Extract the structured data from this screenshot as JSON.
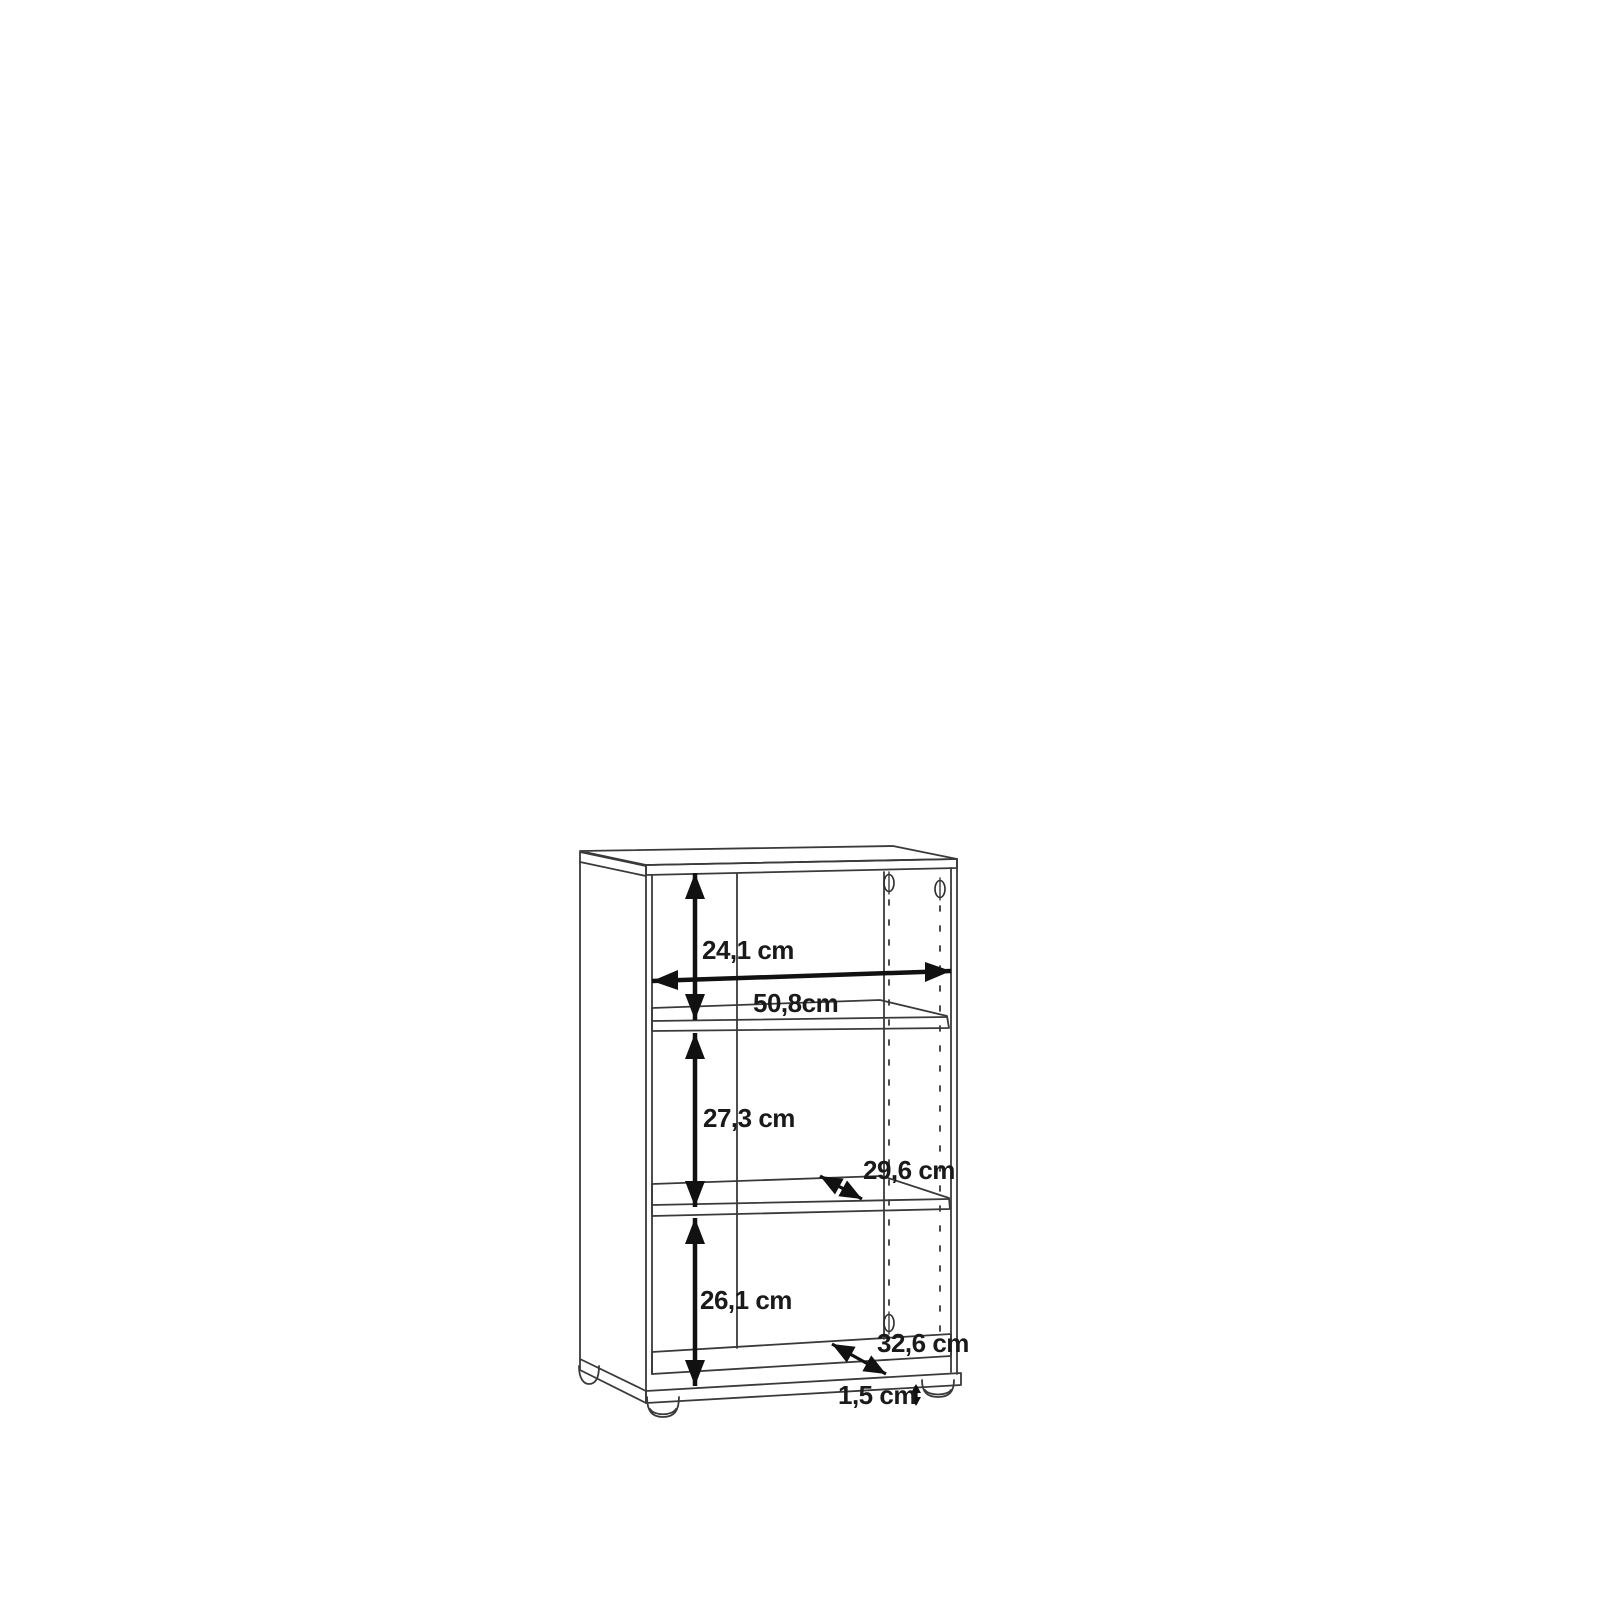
{
  "drawing": {
    "unit": "cm",
    "labels": {
      "top_section_height": "24,1 cm",
      "inner_width": "50,8cm",
      "middle_section_height": "27,3 cm",
      "shelf_depth": "29,6 cm",
      "bottom_section_height": "26,1 cm",
      "base_depth": "32,6 cm",
      "foot_height": "1,5 cm"
    },
    "colors": {
      "background": "#ffffff",
      "outline": "#3a3a3a",
      "dimension": "#111111",
      "text": "#1a1a1a"
    }
  }
}
